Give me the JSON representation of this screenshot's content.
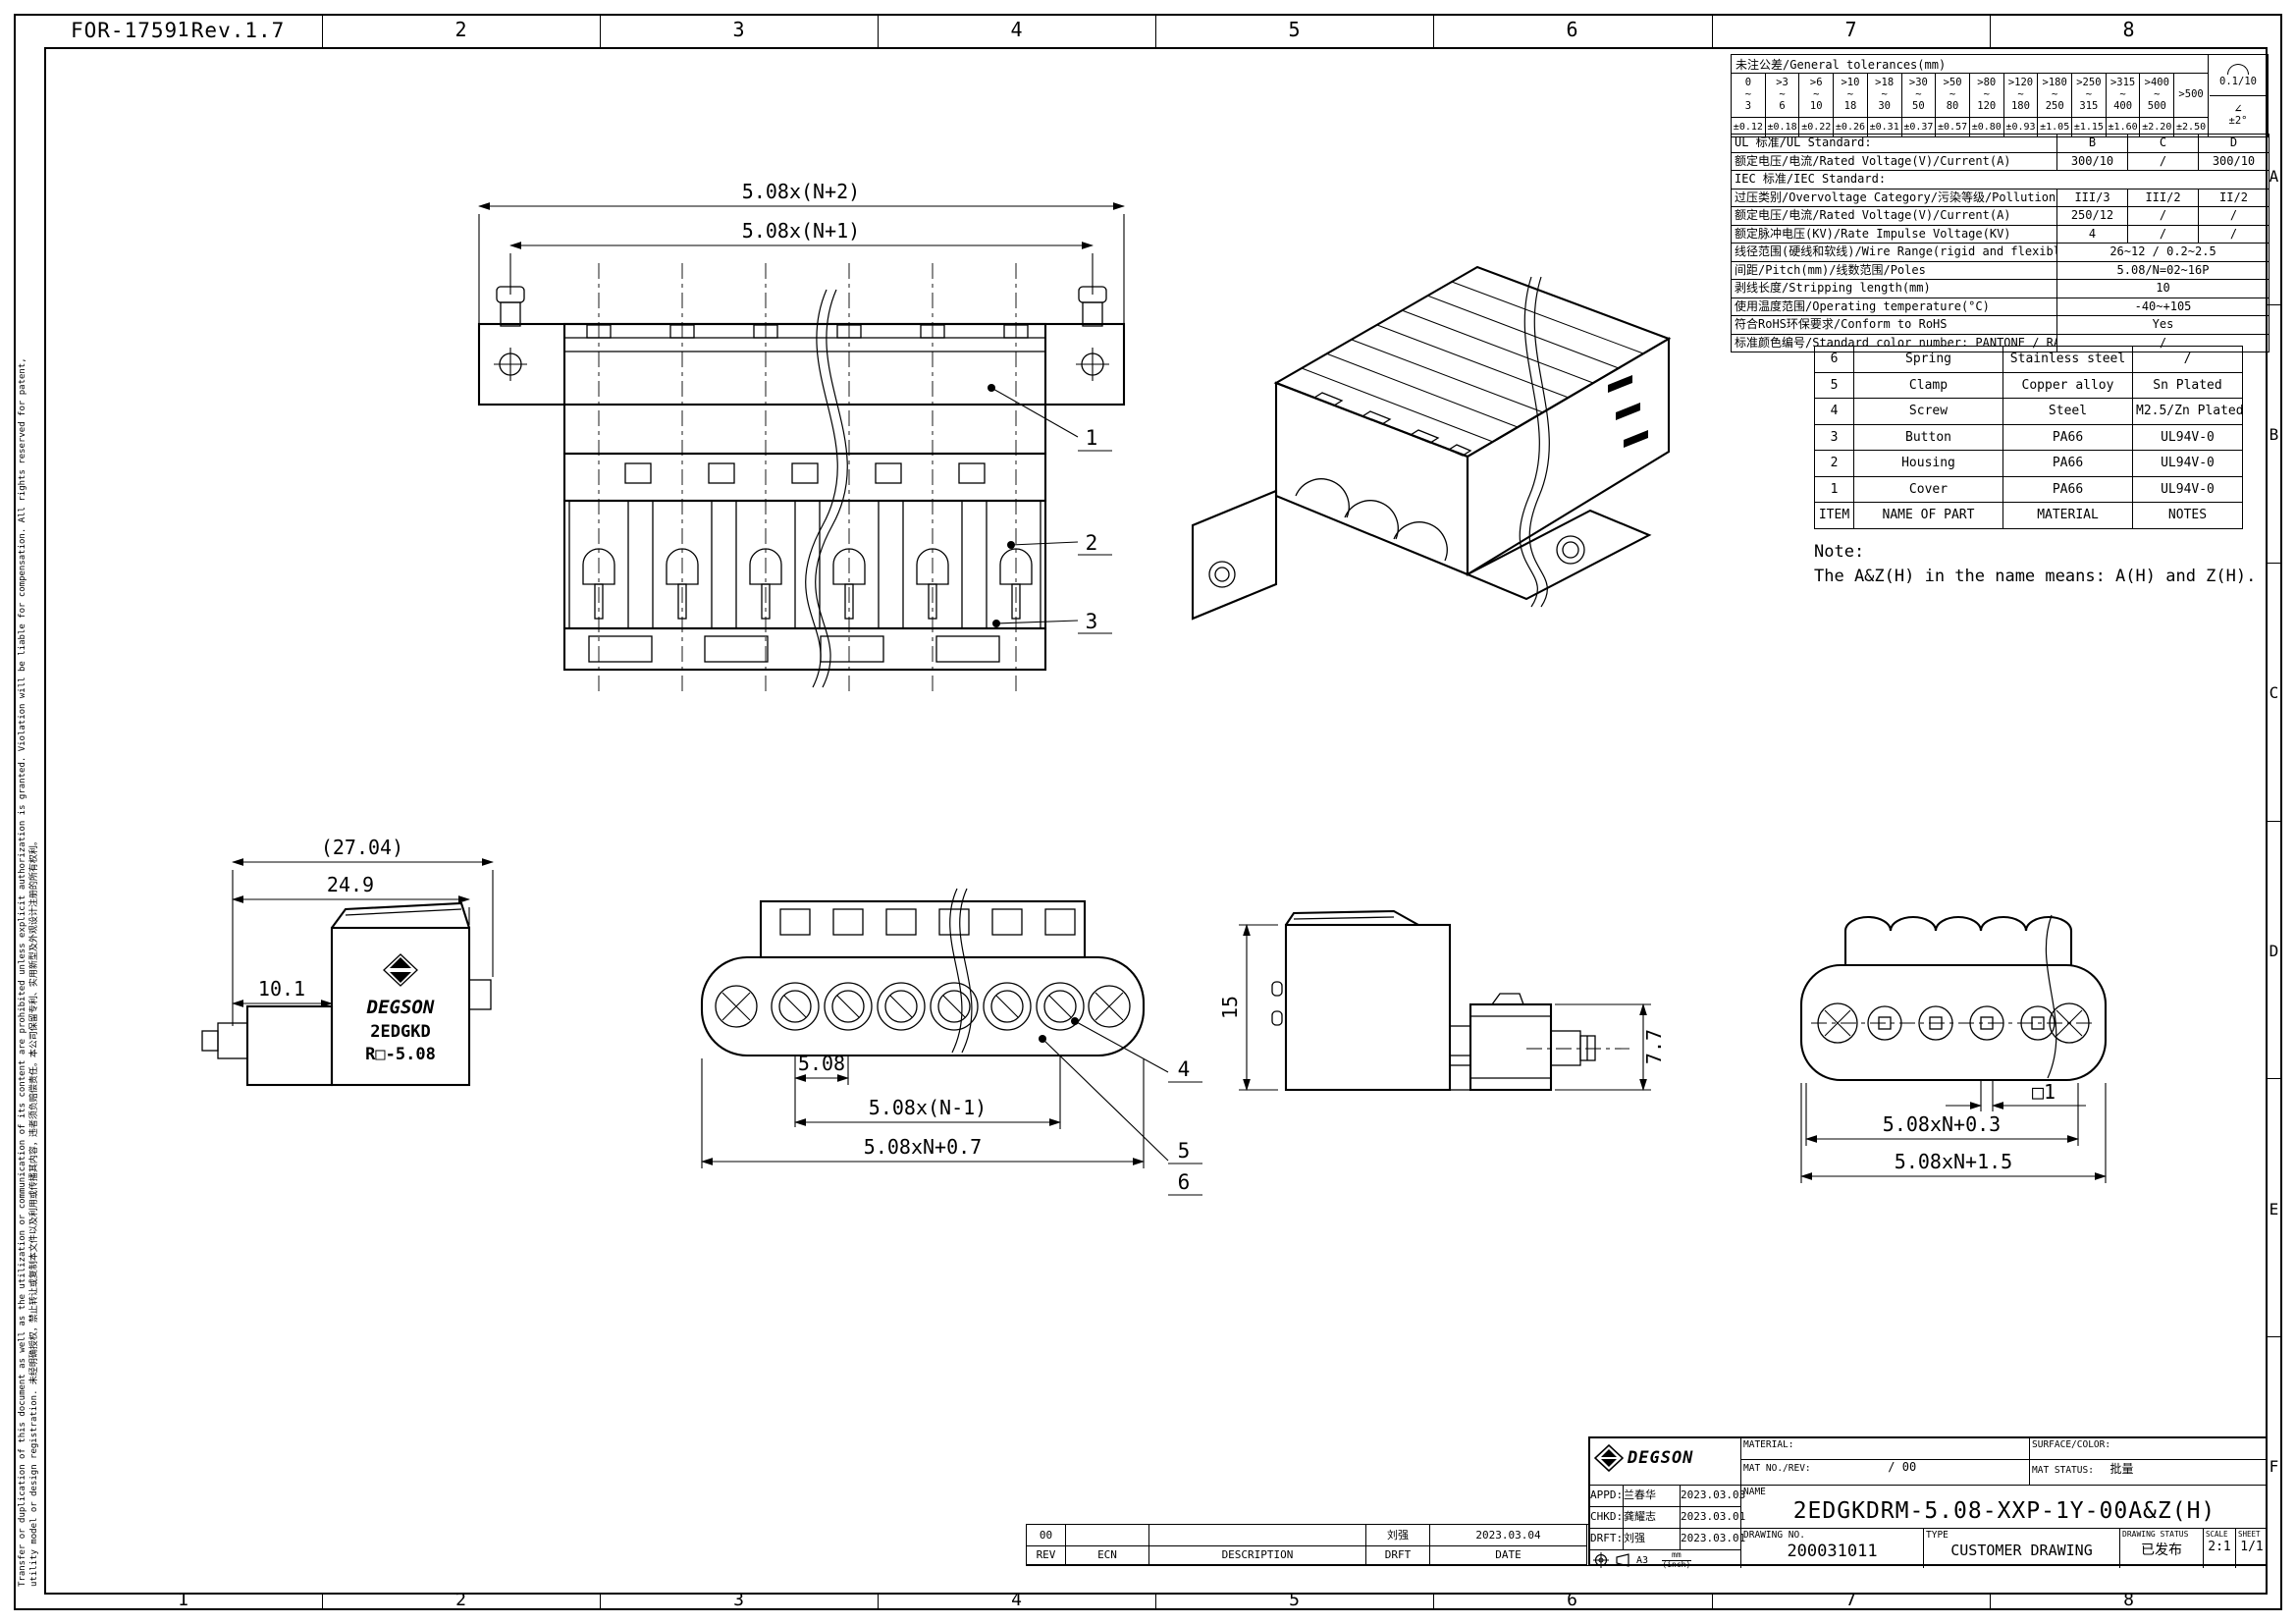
{
  "meta": {
    "form_no": "FOR-1759 Rev.1.7"
  },
  "border": {
    "columns": [
      "1",
      "2",
      "3",
      "4",
      "5",
      "6",
      "7",
      "8"
    ],
    "rows": [
      "A",
      "B",
      "C",
      "D",
      "E",
      "F"
    ]
  },
  "side_note": {
    "line1": "Transfer or duplication of this document as well as the utilization or communication of its content are prohibited unless explicit authorization is granted. Violation will be liable for compensation. All rights reserved for patent,",
    "line2": "utility model or design registration. 未经明确授权，禁止转让或复制本文件以及利用或传播其内容，违者须负赔偿责任。本公司保留专利、实用新型及外观设计注册的所有权利。"
  },
  "tolerance_table": {
    "title": "未注公差/General tolerances(mm)",
    "ranges": [
      "0\n~\n3",
      ">3\n~\n6",
      ">6\n~\n10",
      ">10\n~\n18",
      ">18\n~\n30",
      ">30\n~\n50",
      ">50\n~\n80",
      ">80\n~\n120",
      ">120\n~\n180",
      ">180\n~\n250",
      ">250\n~\n315",
      ">315\n~\n400",
      ">400\n~\n500",
      ">500"
    ],
    "tolerances": [
      "±0.12",
      "±0.18",
      "±0.22",
      "±0.26",
      "±0.31",
      "±0.37",
      "±0.57",
      "±0.80",
      "±0.93",
      "±1.05",
      "±1.15",
      "±1.60",
      "±2.20",
      "±2.50"
    ],
    "flatness": "0.1/10",
    "angle": "±2°"
  },
  "icons": {
    "angle_glyph": "∠"
  },
  "spec_table": {
    "ul_row": {
      "label": "UL 标准/UL Standard:",
      "cols": [
        "B",
        "C",
        "D"
      ]
    },
    "rows": [
      {
        "label": "额定电压/电流/Rated Voltage(V)/Current(A)",
        "v1": "300/10",
        "v2": "/",
        "v3": "300/10"
      },
      {
        "label": "IEC 标准/IEC Standard:"
      },
      {
        "label": "过压类别/Overvoltage Category/污染等级/Pollution Degree",
        "v1": "III/3",
        "v2": "III/2",
        "v3": "II/2"
      },
      {
        "label": "额定电压/电流/Rated Voltage(V)/Current(A)",
        "v1": "250/12",
        "v2": "/",
        "v3": "/"
      },
      {
        "label": "额定脉冲电压(KV)/Rate Impulse Voltage(KV)",
        "v1": "4",
        "v2": "/",
        "v3": "/"
      },
      {
        "label": "线径范围(硬线和软线)/Wire Range(rigid and flexible)(AWG/mm²)",
        "value": "26~12 / 0.2~2.5"
      },
      {
        "label": "间距/Pitch(mm)/线数范围/Poles",
        "value": "5.08/N=02~16P"
      },
      {
        "label": "剥线长度/Stripping length(mm)",
        "value": "10"
      },
      {
        "label": "使用温度范围/Operating temperature(°C)",
        "value": "-40~+105"
      },
      {
        "label": "符合RoHS环保要求/Conform to RoHS",
        "value": "Yes"
      },
      {
        "label": "标准颜色编号/Standard color number: PANTONE / RAL",
        "value": "/"
      }
    ]
  },
  "parts_table": {
    "headers": [
      "ITEM",
      "NAME OF PART",
      "MATERIAL",
      "NOTES"
    ],
    "rows": [
      {
        "item": "6",
        "name": "Spring",
        "material": "Stainless steel",
        "notes": "/"
      },
      {
        "item": "5",
        "name": "Clamp",
        "material": "Copper alloy",
        "notes": "Sn Plated"
      },
      {
        "item": "4",
        "name": "Screw",
        "material": "Steel",
        "notes": "M2.5/Zn Plated"
      },
      {
        "item": "3",
        "name": "Button",
        "material": "PA66",
        "notes": "UL94V-0"
      },
      {
        "item": "2",
        "name": "Housing",
        "material": "PA66",
        "notes": "UL94V-0"
      },
      {
        "item": "1",
        "name": "Cover",
        "material": "PA66",
        "notes": "UL94V-0"
      }
    ]
  },
  "note": {
    "title": "Note:",
    "body": "The A&Z(H) in the name means: A(H) and Z(H)."
  },
  "views": {
    "front_top": {
      "dim_outer": "5.08x(N+2)",
      "dim_inner": "5.08x(N+1)",
      "callout_1": "1",
      "callout_2": "2",
      "callout_3": "3"
    },
    "side_left": {
      "dim_overall": "(27.04)",
      "dim_body": "24.9",
      "dim_front": "10.1",
      "brand_logo": "DEGSON",
      "brand_series": "2EDGKD",
      "brand_model": "R□-5.08"
    },
    "front_bottom": {
      "dim_pitch": "5.08",
      "dim_span": "5.08x(N-1)",
      "dim_overall": "5.08xN+0.7",
      "callout_4": "4",
      "callout_5": "5",
      "callout_6": "6"
    },
    "side_right": {
      "dim_height": "15",
      "dim_pin_height": "7.7"
    },
    "back": {
      "dim_pin": "□1",
      "dim_span": "5.08xN+0.3",
      "dim_overall": "5.08xN+1.5"
    }
  },
  "title_block": {
    "brand": "DEGSON",
    "material_label": "MATERIAL:",
    "mat_no_label": "MAT NO./REV:",
    "mat_no_value": "/ 00",
    "surface_label": "SURFACE/COLOR:",
    "mat_status_label": "MAT STATUS:",
    "mat_status_value": "批量",
    "appd_label": "APPD:",
    "appd_name": "兰春华",
    "appd_date": "2023.03.03",
    "chkd_label": "CHKD:",
    "chkd_name": "龚耀志",
    "chkd_date": "2023.03.01",
    "drft_label": "DRFT:",
    "drft_name": "刘强",
    "drft_date": "2023.03.01",
    "paper_size": "A3",
    "unit_top": "mm",
    "unit_bottom": "(inch)",
    "name_label": "NAME",
    "name_value": "2EDGKDRM-5.08-XXP-1Y-00A&Z(H)",
    "drawing_no_label": "DRAWING NO.",
    "drawing_no": "200031011",
    "type_label": "TYPE",
    "type_value": "CUSTOMER DRAWING",
    "status_label": "DRAWING STATUS",
    "status_value": "已发布",
    "scale_label": "SCALE",
    "scale_value": "2:1",
    "sheet_label": "SHEET",
    "sheet_value": "1/1"
  },
  "revision_strip": {
    "rev_value": "00",
    "ecn_value": "",
    "description_value": "",
    "drft_value": "刘强",
    "date_value": "2023.03.04",
    "headers": [
      "REV",
      "ECN",
      "DESCRIPTION",
      "DRFT",
      "DATE"
    ]
  }
}
